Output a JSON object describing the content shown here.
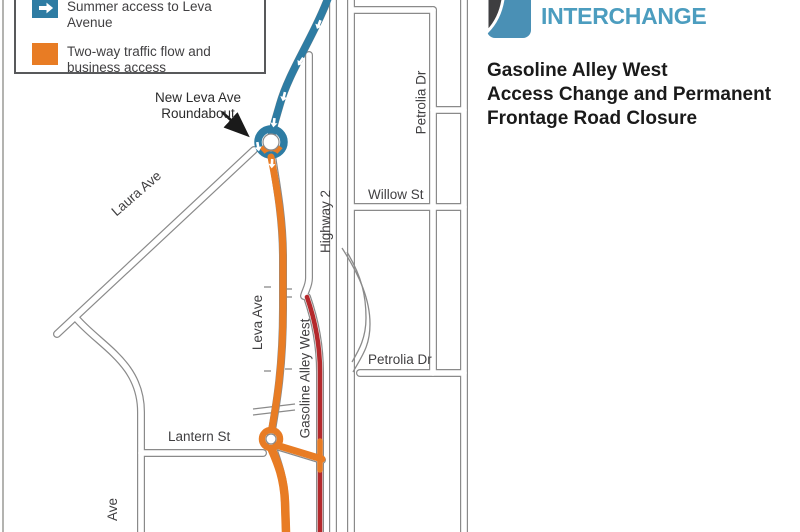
{
  "logo": {
    "word": "INTERCHANGE",
    "word_color": "#4C9DBF",
    "icon": "interchange-logo-icon"
  },
  "title": {
    "line1": "Gasoline Alley West",
    "line2": "Access Change and Permanent",
    "line3": "Frontage Road Closure"
  },
  "legend": {
    "items": [
      {
        "label": "Summer access to Leva Avenue",
        "swatch_color": "#2E7CA3",
        "symbol": "right-arrow"
      },
      {
        "label": "Two-way traffic flow and business access",
        "swatch_color": "#E87C24",
        "symbol": "square"
      }
    ]
  },
  "map": {
    "callout": {
      "line1": "New Leva Ave",
      "line2": "Roundabout"
    },
    "labels": {
      "laura_ave": "Laura Ave",
      "highway_2": "Highway 2",
      "willow_st": "Willow St",
      "petrolia_dr_north": "Petrolia Dr",
      "petrolia_dr_south": "Petrolia Dr",
      "leva_ave": "Leva Ave",
      "gasoline_alley_west": "Gasoline Alley West",
      "lantern_st": "Lantern St",
      "partial_street_ave": "Ave"
    },
    "route_colors": {
      "summer_access_blue": "#2E7CA3",
      "two_way_orange": "#E87C24",
      "closure_red": "#B4292C",
      "road_casing_gray": "#8A8A8A"
    }
  }
}
